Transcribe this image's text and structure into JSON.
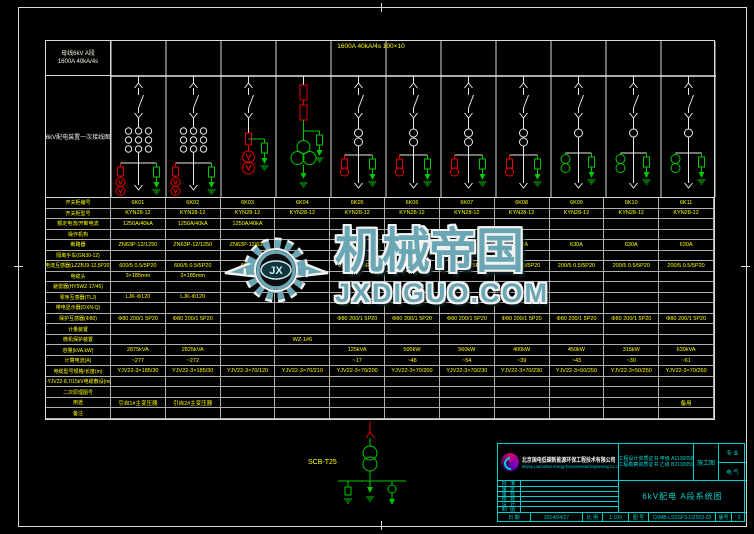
{
  "header": {
    "box_line1": "母线6kV A段",
    "box_line2": "1600A 40kA/4s",
    "sidebar_title": "6kV配电装置一次接线图"
  },
  "schematic": {
    "bus_label": "1600A 40kA/4s 100×10",
    "columns": [
      {
        "id": "6K01",
        "type": "incoming"
      },
      {
        "id": "6K02",
        "type": "incoming"
      },
      {
        "id": "6K03",
        "type": "buspt"
      },
      {
        "id": "6K04",
        "type": "station"
      },
      {
        "id": "6K05",
        "type": "feederA"
      },
      {
        "id": "6K06",
        "type": "feederA"
      },
      {
        "id": "6K07",
        "type": "feederA"
      },
      {
        "id": "6K08",
        "type": "feederA"
      },
      {
        "id": "6K09",
        "type": "feederB"
      },
      {
        "id": "6K10",
        "type": "feederB"
      },
      {
        "id": "6K11",
        "type": "feederB"
      }
    ]
  },
  "table": {
    "rows": [
      {
        "label": "开关柜编号",
        "cells": [
          "6K01",
          "6K02",
          "6K03",
          "6K04",
          "6K05",
          "6K06",
          "6K07",
          "6K08",
          "6K09",
          "6K10",
          "6K11"
        ]
      },
      {
        "label": "开关柜型号",
        "cells": [
          "KYN28-12",
          "KYN28-12",
          "KYN28-12",
          "KYN28-12",
          "KYN28-12",
          "KYN28-12",
          "KYN28-12",
          "KYN28-12",
          "KYN28-12",
          "KYN28-12",
          "KYN28-12"
        ]
      },
      {
        "label": "额定电流/开断电流",
        "cells": [
          "1250A/40kA",
          "1250A/40kA",
          "1250A/40kA",
          "",
          "",
          "",
          "",
          "",
          "",
          "",
          ""
        ]
      },
      {
        "label": "操作机构",
        "cells": [
          "",
          "",
          "",
          "",
          "",
          "",
          "",
          "",
          "",
          "",
          ""
        ]
      },
      {
        "label": "断路器",
        "cells": [
          "ZN63P-12/1250",
          "ZN63P-12/1250",
          "ZN63P-12/630",
          "",
          "630A",
          "630A",
          "630A",
          "630A",
          "630A",
          "630A",
          "630A"
        ]
      },
      {
        "label": "隔离手车(GN30-12)",
        "cells": [
          "",
          "",
          "",
          "",
          "",
          "",
          "",
          "",
          "",
          "",
          ""
        ]
      },
      {
        "label": "电流互感器(LZZBJ9-12,5P20)",
        "cells": [
          "600/5 0.5/5P20",
          "600/5 0.5/5P20",
          "600/5",
          "",
          "200/5 0.5/5P20",
          "200/5 0.5/5P20",
          "200/5 0.5/5P20",
          "200/5 0.5/5P20",
          "200/5 0.5/5P20",
          "200/5 0.5/5P20",
          "200/5 0.5/5P20"
        ]
      },
      {
        "label": "电缆头",
        "cells": [
          "3×185mm",
          "3×185mm",
          "",
          "",
          "",
          "",
          "",
          "",
          "",
          "",
          ""
        ]
      },
      {
        "label": "避雷器(HY5WZ-17/45)",
        "cells": [
          "",
          "",
          "",
          "",
          "",
          "",
          "",
          "",
          "",
          "",
          ""
        ]
      },
      {
        "label": "零序互感器(TLJ)",
        "cells": [
          "LJK-Φ120",
          "LJK-Φ120",
          "",
          "",
          "",
          "",
          "",
          "",
          "",
          "",
          ""
        ]
      },
      {
        "label": "带电显示器(DXN-Q)",
        "cells": [
          "",
          "",
          "",
          "",
          "",
          "",
          "",
          "",
          "",
          "",
          ""
        ]
      },
      {
        "label": "保护互感器(Φ80)",
        "cells": [
          "Φ80 200/1 5P20",
          "Φ80 200/1 5P20",
          "",
          "",
          "Φ80 200/1 5P20",
          "Φ80 200/1 5P20",
          "Φ80 200/1 5P20",
          "Φ80 200/1 5P20",
          "Φ80 200/1 5P20",
          "Φ80 200/1 5P20",
          "Φ80 200/1 5P20"
        ]
      },
      {
        "label": "计量装置",
        "cells": [
          "",
          "",
          "",
          "",
          "",
          "",
          "",
          "",
          "",
          "",
          ""
        ]
      },
      {
        "label": "微机保护装置",
        "cells": [
          "",
          "",
          "",
          "WZ-1#6",
          "",
          "",
          "",
          "",
          "",
          "",
          ""
        ]
      },
      {
        "label": "容量(kVA,kW)",
        "cells": [
          "2875kVA",
          "2825kVA",
          "",
          "",
          "125kVA",
          "500kW",
          "560kW",
          "400kW",
          "450kW",
          "315kW",
          "630kVA"
        ]
      },
      {
        "label": "计算电流(A)",
        "cells": [
          "~277",
          "~272",
          "",
          "",
          "~17",
          "~48",
          "~54",
          "~39",
          "~43",
          "~30",
          "~61"
        ]
      },
      {
        "label": "电缆型号规格/长度(m)",
        "cells": [
          "YJV22-3×185/30",
          "YJV22-3×185/30",
          "YJV22-3×70/120",
          "YJV22-3×70/210",
          "YJV22-3×70/200",
          "YJV22-3×70/200",
          "YJV22-3×70/230",
          "YJV22-3×70/230",
          "YJV22-3×50/250",
          "YJV22-3×50/250",
          "YJV22-3×70/260"
        ]
      },
      {
        "label": "ZR-YJV22-8.7/15kV电缆敷设(mm²)",
        "cells": [
          "",
          "",
          "",
          "",
          "",
          "",
          "",
          "",
          "",
          "",
          ""
        ]
      },
      {
        "label": "二次原理图号",
        "cells": [
          "",
          "",
          "",
          "",
          "",
          "",
          "",
          "",
          "",
          "",
          ""
        ]
      },
      {
        "label": "用途",
        "cells": [
          "引自1#主变压器",
          "引自2#主变压器",
          "",
          "",
          "",
          "",
          "",
          "",
          "",
          "",
          "备用"
        ]
      },
      {
        "label": "备注",
        "cells": [
          "",
          "",
          "",
          "",
          "",
          "",
          "",
          "",
          "",
          "",
          ""
        ]
      }
    ]
  },
  "bottom_detail": {
    "label": "SCB-T25"
  },
  "watermark": {
    "cn": "机械帝国",
    "domain": "JXDIGUO.COM",
    "monogram": "JX"
  },
  "titleblock": {
    "company_cn": "北京国电低碳新能源环保工程技术有限公司",
    "company_en": "Beijing LowCarbon Energy Environmental Engineering Co.,Ltd",
    "cert_line1": "工程设计资质证书 甲级 A1130058",
    "cert_line2": "工程勘察资质证书 乙级 B2130059",
    "stage": "施工图",
    "dept_top": "专 业",
    "dept_bottom": "电 气",
    "sign_rows": [
      "批 准",
      "审 定",
      "审 核",
      "校 核",
      "设 计",
      "制 图"
    ],
    "title": "6kV配电 A段系统图",
    "date_label": "日 期",
    "date": "2014/04/27",
    "scale_label": "比 例",
    "scale": "1:100",
    "no_label": "图 号",
    "number": "C6MB-LSSSFS-DZ503-03",
    "rev_label": "版号",
    "rev": "0"
  }
}
